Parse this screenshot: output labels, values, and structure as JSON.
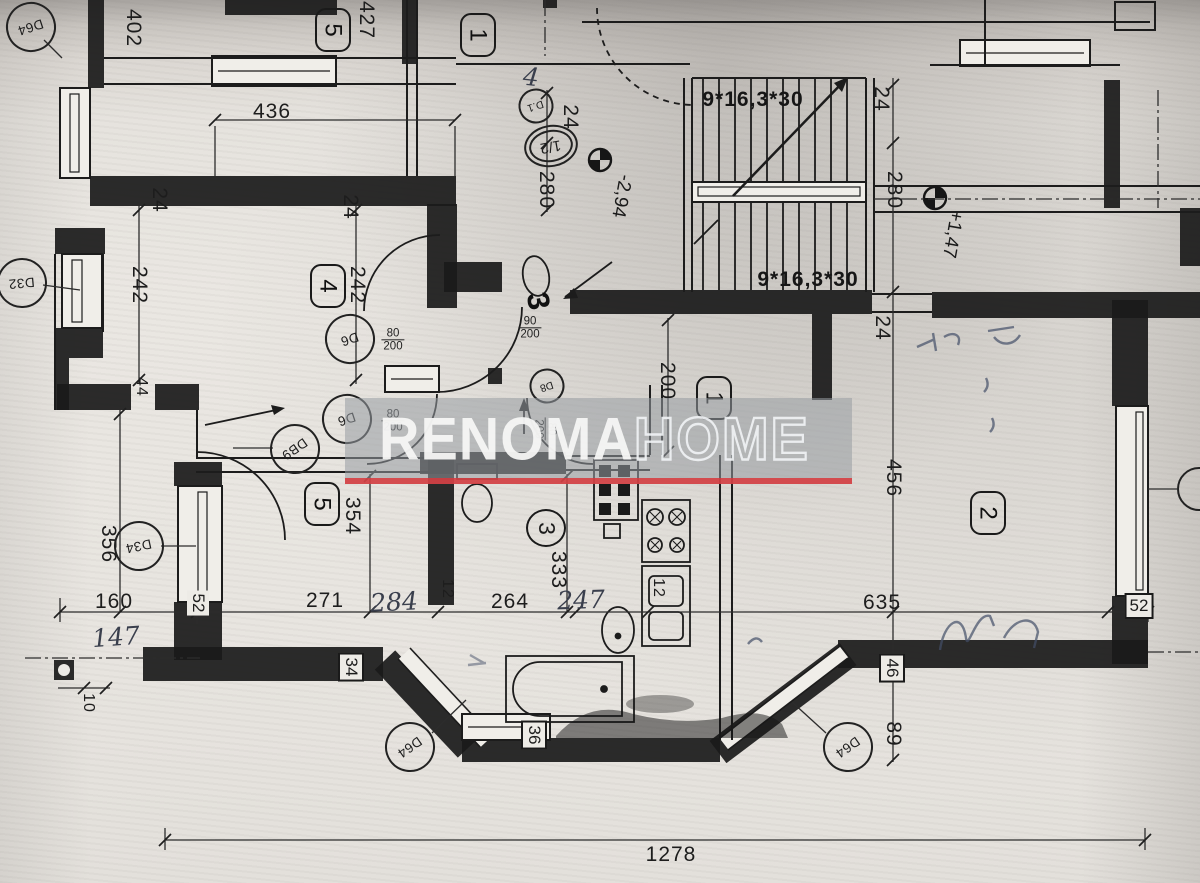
{
  "watermark": {
    "brand_bold": "RENOMA",
    "brand_light": "HOME",
    "band_color": "rgba(151,156,163,0.55)",
    "underline_color": "rgba(216,56,60,0.85)"
  },
  "stairs": {
    "flight_formula": "9*16,3*30",
    "flights": 2,
    "risers_per_flight": 9
  },
  "levels": {
    "lower": "-2,94",
    "upper": "+1,47"
  },
  "rooms": [
    "1",
    "2",
    "3",
    "4",
    "5"
  ],
  "door_codes": [
    "D64",
    "D32",
    "D6",
    "DB9",
    "D34",
    "D8",
    "D.1"
  ],
  "labels": [
    {
      "n": "dim-436",
      "t": "436",
      "x": 272,
      "y": 112,
      "r": 0,
      "k": "dim"
    },
    {
      "n": "dim-427",
      "t": "427",
      "x": 366,
      "y": 20,
      "r": 90,
      "k": "dim"
    },
    {
      "n": "dim-402",
      "t": "402",
      "x": 133,
      "y": 28,
      "r": 90,
      "k": "dim"
    },
    {
      "n": "dim-24-a",
      "t": "24",
      "x": 159,
      "y": 200,
      "r": 90,
      "k": "dim"
    },
    {
      "n": "dim-24-b",
      "t": "24",
      "x": 350,
      "y": 207,
      "r": 90,
      "k": "dim"
    },
    {
      "n": "dim-242-a",
      "t": "242",
      "x": 139,
      "y": 285,
      "r": 90,
      "k": "dim"
    },
    {
      "n": "dim-242-b",
      "t": "242",
      "x": 357,
      "y": 285,
      "r": 90,
      "k": "dim"
    },
    {
      "n": "dim-44",
      "t": "44",
      "x": 141,
      "y": 387,
      "r": 90,
      "k": "dimS"
    },
    {
      "n": "dim-24-c",
      "t": "24",
      "x": 570,
      "y": 117,
      "r": 90,
      "k": "dim"
    },
    {
      "n": "dim-280-a",
      "t": "280",
      "x": 546,
      "y": 190,
      "r": 90,
      "k": "dim"
    },
    {
      "n": "dim-24-d",
      "t": "24",
      "x": 881,
      "y": 99,
      "r": 90,
      "k": "dim"
    },
    {
      "n": "dim-280-b",
      "t": "280",
      "x": 894,
      "y": 190,
      "r": 90,
      "k": "dim"
    },
    {
      "n": "dim-24-e",
      "t": "24",
      "x": 882,
      "y": 328,
      "r": 90,
      "k": "dim"
    },
    {
      "n": "dim-200",
      "t": "200",
      "x": 667,
      "y": 381,
      "r": 90,
      "k": "dim"
    },
    {
      "n": "dim-456",
      "t": "456",
      "x": 893,
      "y": 478,
      "r": 90,
      "k": "dim"
    },
    {
      "n": "dim-354",
      "t": "354",
      "x": 352,
      "y": 516,
      "r": 90,
      "k": "dim"
    },
    {
      "n": "dim-356",
      "t": "356",
      "x": 108,
      "y": 544,
      "r": 90,
      "k": "dim"
    },
    {
      "n": "dim-333",
      "t": "333",
      "x": 558,
      "y": 570,
      "r": 90,
      "k": "dim"
    },
    {
      "n": "dim-271",
      "t": "271",
      "x": 325,
      "y": 601,
      "r": 0,
      "k": "dim"
    },
    {
      "n": "dim-264",
      "t": "264",
      "x": 510,
      "y": 602,
      "r": 0,
      "k": "dim"
    },
    {
      "n": "dim-160",
      "t": "160",
      "x": 114,
      "y": 602,
      "r": 0,
      "k": "dim"
    },
    {
      "n": "dim-635",
      "t": "635",
      "x": 882,
      "y": 603,
      "r": 0,
      "k": "dim"
    },
    {
      "n": "dim-12-a",
      "t": "12",
      "x": 447,
      "y": 589,
      "r": 90,
      "k": "dimS"
    },
    {
      "n": "dim-12-b",
      "t": "12",
      "x": 658,
      "y": 588,
      "r": 90,
      "k": "dimS"
    },
    {
      "n": "dim-89",
      "t": "89",
      "x": 893,
      "y": 734,
      "r": 90,
      "k": "dim"
    },
    {
      "n": "dim-10",
      "t": "10",
      "x": 88,
      "y": 703,
      "r": 90,
      "k": "dimS"
    },
    {
      "n": "dim-1278",
      "t": "1278",
      "x": 671,
      "y": 855,
      "r": 0,
      "k": "dim"
    },
    {
      "n": "dim-52-left",
      "t": "52",
      "x": 198,
      "y": 603,
      "r": 90,
      "k": "boxp"
    },
    {
      "n": "dim-52-right",
      "t": "52",
      "x": 1139,
      "y": 606,
      "r": 0,
      "k": "box"
    },
    {
      "n": "dim-46",
      "t": "46",
      "x": 892,
      "y": 668,
      "r": 90,
      "k": "box"
    },
    {
      "n": "dim-34",
      "t": "34",
      "x": 351,
      "y": 667,
      "r": 90,
      "k": "box"
    },
    {
      "n": "dim-36",
      "t": "36",
      "x": 534,
      "y": 735,
      "r": 90,
      "k": "box"
    },
    {
      "n": "handwritten-147",
      "t": "147",
      "x": 116,
      "y": 637,
      "r": -4,
      "k": "hw"
    },
    {
      "n": "handwritten-284",
      "t": "284",
      "x": 394,
      "y": 602,
      "r": -3,
      "k": "hw"
    },
    {
      "n": "handwritten-247",
      "t": "247",
      "x": 581,
      "y": 600,
      "r": -2,
      "k": "hw"
    },
    {
      "n": "handwritten-4",
      "t": "4",
      "x": 531,
      "y": 77,
      "r": 6,
      "k": "hw"
    },
    {
      "n": "stair-formula-top",
      "t": "9*16,3*30",
      "x": 753,
      "y": 100,
      "r": 0,
      "k": "stair"
    },
    {
      "n": "stair-formula-bottom",
      "t": "9*16,3*30",
      "x": 808,
      "y": 280,
      "r": 0,
      "k": "stair"
    },
    {
      "n": "level-minus-294",
      "t": "-2,94",
      "x": 621,
      "y": 196,
      "r": 100,
      "k": "lvl"
    },
    {
      "n": "level-plus-147",
      "t": "+1,47",
      "x": 952,
      "y": 234,
      "r": 100,
      "k": "lvl"
    },
    {
      "n": "room-badge-5-top",
      "t": "5",
      "x": 333,
      "y": 30,
      "r": 0,
      "k": "badge"
    },
    {
      "n": "room-badge-1-top",
      "t": "1",
      "x": 478,
      "y": 35,
      "r": 0,
      "k": "badge"
    },
    {
      "n": "room-badge-4",
      "t": "4",
      "x": 328,
      "y": 286,
      "r": 0,
      "k": "badge"
    },
    {
      "n": "room-badge-5",
      "t": "5",
      "x": 322,
      "y": 504,
      "r": 0,
      "k": "badge"
    },
    {
      "n": "room-badge-3",
      "t": "3",
      "x": 546,
      "y": 528,
      "r": 0,
      "k": "circle3"
    },
    {
      "n": "room-badge-1",
      "t": "1",
      "x": 714,
      "y": 398,
      "r": 0,
      "k": "badge"
    },
    {
      "n": "room-badge-2",
      "t": "2",
      "x": 988,
      "y": 513,
      "r": 0,
      "k": "badge"
    },
    {
      "n": "stair-number-3",
      "t": "3",
      "x": 538,
      "y": 301,
      "r": 80,
      "k": "big3"
    },
    {
      "n": "door-label-d64-topleft",
      "t": "D64",
      "x": 31,
      "y": 27,
      "r": 72,
      "k": "door"
    },
    {
      "n": "door-label-d32",
      "t": "D32",
      "x": 22,
      "y": 283,
      "r": 85,
      "k": "door"
    },
    {
      "n": "door-label-d6-upper",
      "t": "D6",
      "x": 350,
      "y": 339,
      "r": 72,
      "k": "door"
    },
    {
      "n": "door-label-d6-lower",
      "t": "D6",
      "x": 347,
      "y": 419,
      "r": 72,
      "k": "door"
    },
    {
      "n": "door-label-db9",
      "t": "DB9",
      "x": 295,
      "y": 449,
      "r": 55,
      "k": "door"
    },
    {
      "n": "door-label-d34",
      "t": "D34",
      "x": 139,
      "y": 546,
      "r": 78,
      "k": "door"
    },
    {
      "n": "door-label-d8",
      "t": "D8",
      "x": 547,
      "y": 386,
      "r": 72,
      "k": "doorS"
    },
    {
      "n": "door-label-d1",
      "t": "D.1",
      "x": 536,
      "y": 106,
      "r": 72,
      "k": "doorS"
    },
    {
      "n": "marker-half",
      "t": "1/2",
      "x": 551,
      "y": 146,
      "r": 80,
      "k": "stadium"
    },
    {
      "n": "door-label-d64-bottomleft",
      "t": "D64",
      "x": 410,
      "y": 747,
      "r": 55,
      "k": "door"
    },
    {
      "n": "door-label-d64-bottomright",
      "t": "D64",
      "x": 848,
      "y": 747,
      "r": 55,
      "k": "door"
    },
    {
      "n": "doorsize-d6-upper",
      "t": "80|200",
      "x": 393,
      "y": 340,
      "r": 0,
      "k": "frac"
    },
    {
      "n": "doorsize-d6-lower",
      "t": "80|200",
      "x": 393,
      "y": 421,
      "r": 0,
      "k": "frac"
    },
    {
      "n": "doorsize-d8",
      "t": "80|200",
      "x": 545,
      "y": 429,
      "r": 90,
      "k": "frac"
    },
    {
      "n": "doorsize-entrance",
      "t": "90|200",
      "x": 530,
      "y": 328,
      "r": 0,
      "k": "frac"
    }
  ]
}
